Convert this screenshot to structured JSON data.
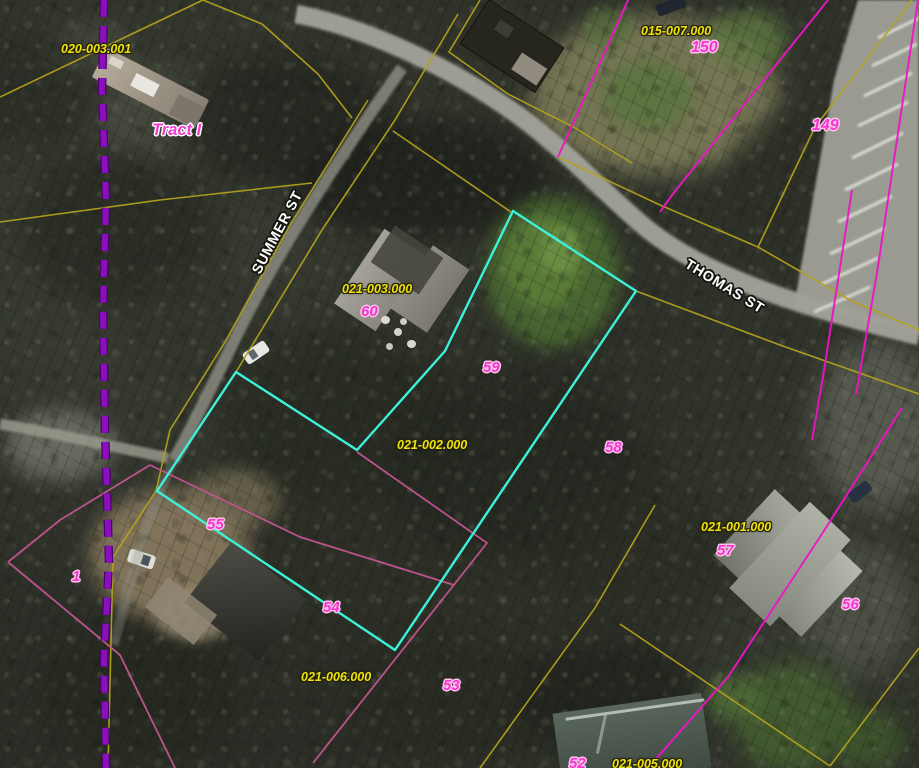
{
  "map": {
    "type": "gis-parcel-viewer-aerial",
    "streets": [
      {
        "name": "SUMMER ST"
      },
      {
        "name": "THOMAS ST"
      }
    ],
    "tract": "Tract I",
    "labels": [
      {
        "text": "020-003.001",
        "kind": "parcel-id"
      },
      {
        "text": "Tract I",
        "kind": "tract"
      },
      {
        "text": "015-007.000",
        "kind": "parcel-id"
      },
      {
        "text": "150",
        "kind": "lot-number"
      },
      {
        "text": "149",
        "kind": "lot-number"
      },
      {
        "text": "SUMMER ST",
        "kind": "street"
      },
      {
        "text": "THOMAS ST",
        "kind": "street"
      },
      {
        "text": "021-003.000",
        "kind": "parcel-id"
      },
      {
        "text": "60",
        "kind": "lot-number"
      },
      {
        "text": "59",
        "kind": "lot-number"
      },
      {
        "text": "58",
        "kind": "lot-number"
      },
      {
        "text": "021-002.000",
        "kind": "parcel-id"
      },
      {
        "text": "021-001.000",
        "kind": "parcel-id"
      },
      {
        "text": "57",
        "kind": "lot-number"
      },
      {
        "text": "56",
        "kind": "lot-number"
      },
      {
        "text": "55",
        "kind": "lot-number"
      },
      {
        "text": "1",
        "kind": "lot-number"
      },
      {
        "text": "54",
        "kind": "lot-number"
      },
      {
        "text": "021-006.000",
        "kind": "parcel-id"
      },
      {
        "text": "53",
        "kind": "lot-number"
      },
      {
        "text": "52",
        "kind": "lot-number"
      },
      {
        "text": "021-005.000",
        "kind": "parcel-id"
      }
    ],
    "colors": {
      "parcel_line_yellow": "#b2a21c",
      "parcel_line_magenta": "#ef14c6",
      "parcel_line_pink": "#c35691",
      "highlight_outline": "#3df2da",
      "dashed_boundary_purple": "#8a10bc",
      "label_yellow": "#ece213",
      "label_number_magenta": "#f336cd",
      "street_label_white": "#ffffff",
      "road_gray": "#a6a69c"
    }
  }
}
